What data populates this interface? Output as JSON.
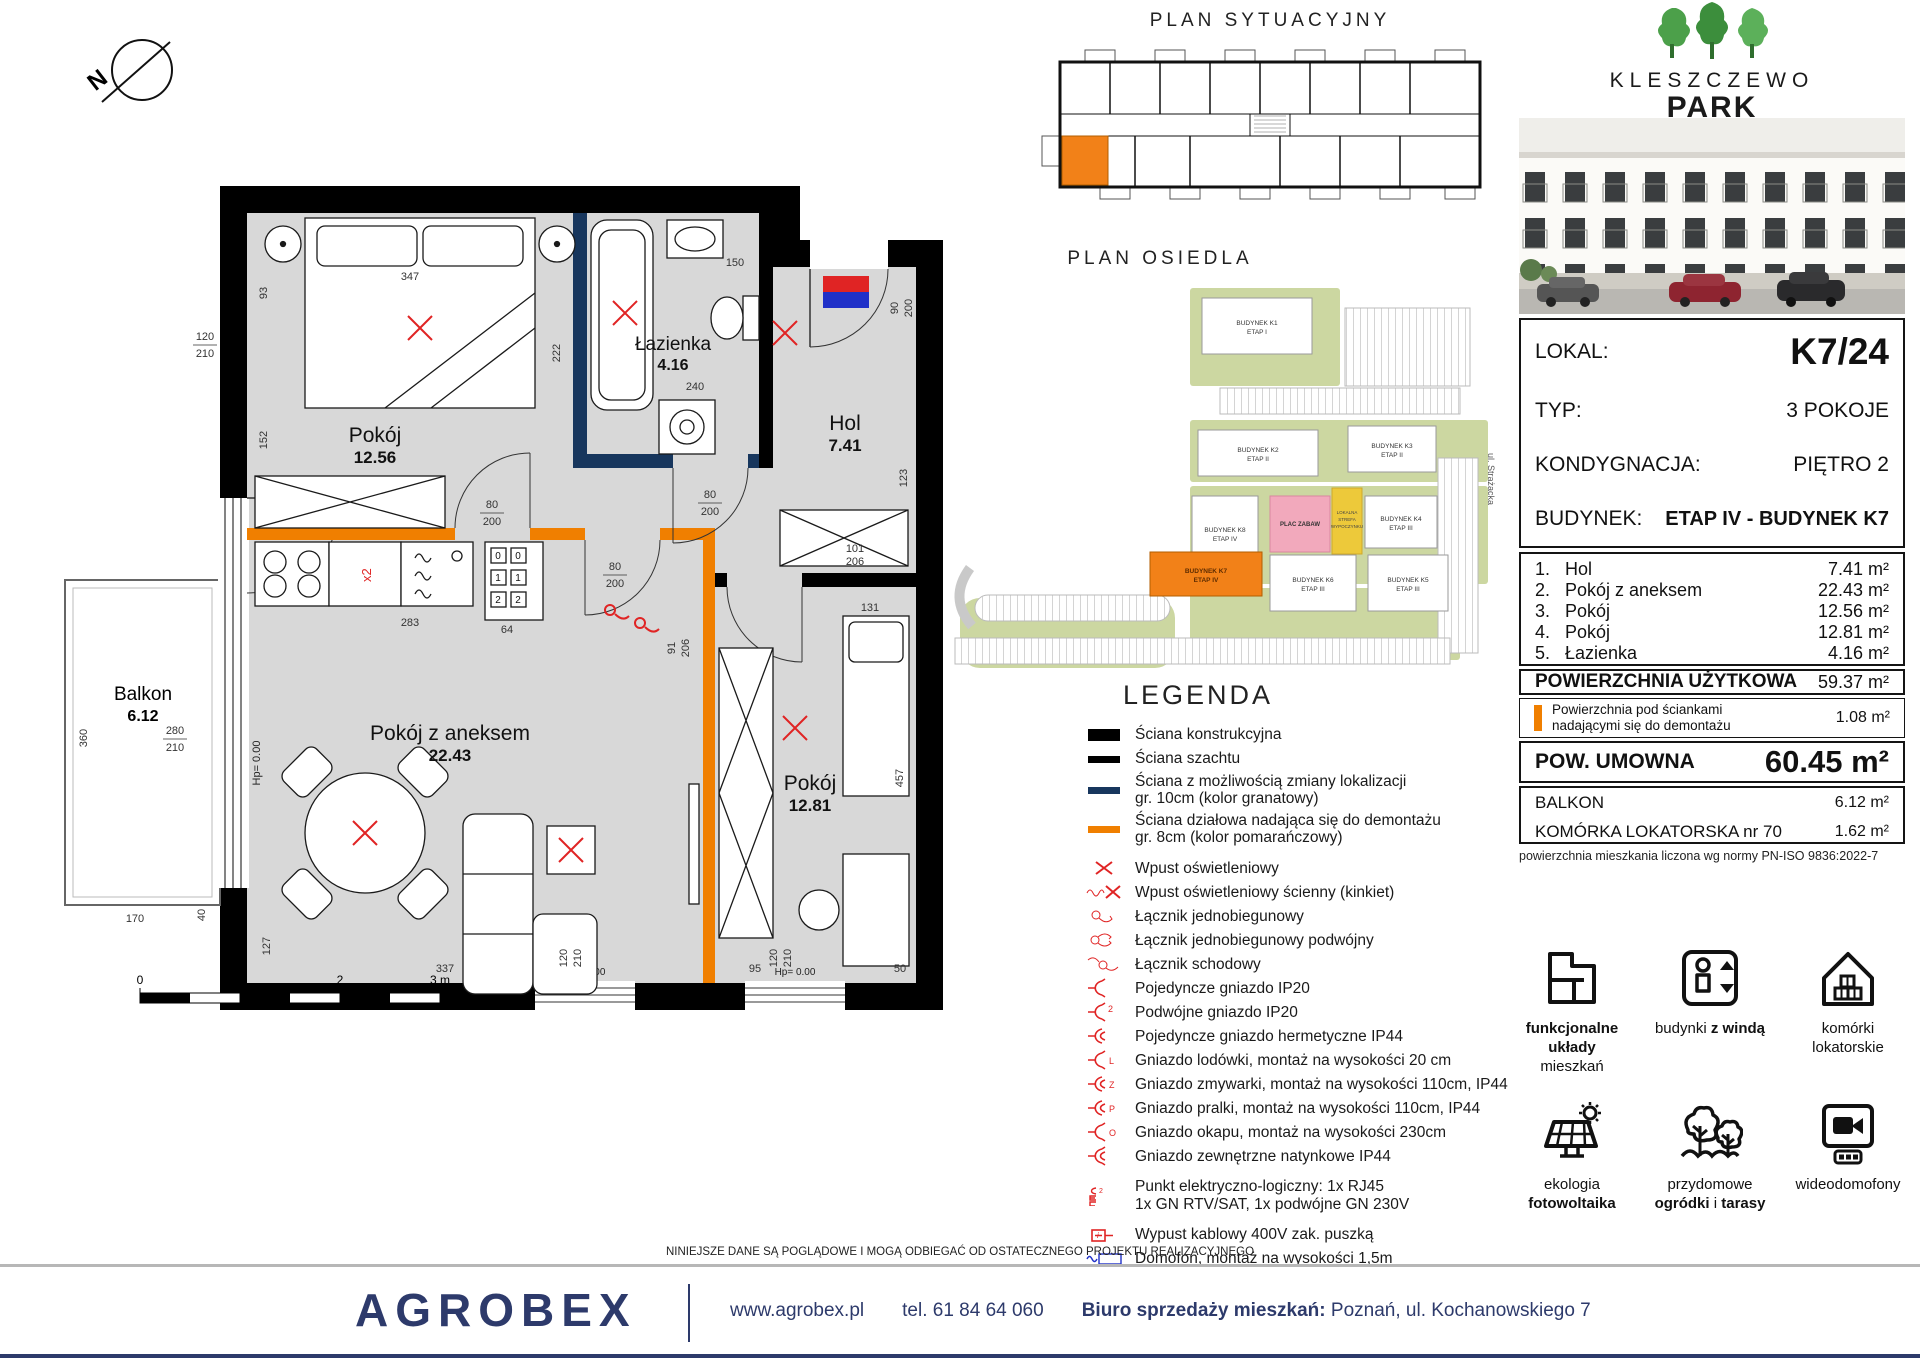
{
  "compass": {
    "label": "N"
  },
  "floor_plan": {
    "rooms": {
      "pokoj1": {
        "name": "Pokój",
        "area": "12.56"
      },
      "lazienka": {
        "name": "Łazienka",
        "area": "4.16"
      },
      "hol": {
        "name": "Hol",
        "area": "7.41"
      },
      "pokoj_aneks": {
        "name": "Pokój z aneksem",
        "area": "22.43"
      },
      "pokoj2": {
        "name": "Pokój",
        "area": "12.81"
      },
      "balkon": {
        "name": "Balkon",
        "area": "6.12"
      }
    },
    "hp_label": "Hp= 0.00",
    "socket_label": "x2",
    "appliance_codes": [
      "0",
      "0",
      "1",
      "1",
      "2",
      "2"
    ],
    "dims": {
      "d347": "347",
      "d93": "93",
      "d150": "150",
      "d120": "120",
      "d210": "210",
      "d152": "152",
      "d222": "222",
      "d240": "240",
      "d80": "80",
      "d200": "200",
      "d90": "90",
      "d101": "101",
      "d206": "206",
      "d123": "123",
      "d91": "91",
      "d283": "283",
      "d64": "64",
      "d337": "337",
      "d127": "127",
      "d457": "457",
      "d131": "131",
      "d95": "95",
      "d50": "50",
      "d360": "360",
      "d170": "170",
      "d40": "40",
      "d280": "280"
    },
    "scale_ticks": [
      "0",
      "1",
      "2",
      "3 m"
    ]
  },
  "plan_sytuacyjny": {
    "title": "PLAN SYTUACYJNY"
  },
  "plan_osiedla": {
    "title": "PLAN OSIEDLA",
    "street": "ul. Strażacka",
    "plac_zabaw": "PLAC ZABAW",
    "strefa": [
      "LOKALNA",
      "STREFA",
      "WYPOCZYNKU"
    ],
    "buildings": [
      {
        "name": "BUDYNEK K1",
        "etap": "ETAP I",
        "highlight": false
      },
      {
        "name": "BUDYNEK K2",
        "etap": "ETAP II",
        "highlight": false
      },
      {
        "name": "BUDYNEK K3",
        "etap": "ETAP II",
        "highlight": false
      },
      {
        "name": "BUDYNEK K8",
        "etap": "ETAP IV",
        "highlight": false
      },
      {
        "name": "BUDYNEK K4",
        "etap": "ETAP III",
        "highlight": false
      },
      {
        "name": "BUDYNEK K7",
        "etap": "ETAP IV",
        "highlight": true
      },
      {
        "name": "BUDYNEK K6",
        "etap": "ETAP III",
        "highlight": false
      },
      {
        "name": "BUDYNEK K5",
        "etap": "ETAP III",
        "highlight": false
      }
    ]
  },
  "legend": {
    "title": "LEGENDA",
    "items": [
      {
        "icon": "wall_constr",
        "label": "Ściana konstrukcyjna"
      },
      {
        "icon": "wall_shaft",
        "label": "Ściana szachtu"
      },
      {
        "icon": "wall_navy",
        "label": "Ściana z możliwością zmiany lokalizacji",
        "label2": "gr. 10cm (kolor granatowy)"
      },
      {
        "icon": "wall_orange",
        "label": "Ściana działowa nadająca się do demontażu",
        "label2": "gr. 8cm (kolor pomarańczowy)"
      },
      {
        "icon": "x",
        "label": "Wpust oświetleniowy"
      },
      {
        "icon": "kinkiet",
        "label": "Wpust oświetleniowy ścienny (kinkiet)"
      },
      {
        "icon": "lacznik1",
        "label": "Łącznik jednobiegunowy"
      },
      {
        "icon": "lacznik2",
        "label": "Łącznik jednobiegunowy podwójny"
      },
      {
        "icon": "lacznik_s",
        "label": "Łącznik schodowy"
      },
      {
        "icon": "gn",
        "label": "Pojedyncze gniazdo IP20"
      },
      {
        "icon": "gn2",
        "label": "Podwójne gniazdo IP20"
      },
      {
        "icon": "gnh",
        "label": "Pojedyncze gniazdo hermetyczne IP44"
      },
      {
        "icon": "gnL",
        "label": "Gniazdo lodówki, montaż na wysokości 20 cm"
      },
      {
        "icon": "gnZ",
        "label": "Gniazdo zmywarki, montaż na wysokości 110cm,  IP44"
      },
      {
        "icon": "gnP",
        "label": "Gniazdo pralki, montaż na wysokości 110cm, IP44"
      },
      {
        "icon": "gnO",
        "label": "Gniazdo okapu, montaż na wysokości 230cm"
      },
      {
        "icon": "gnN",
        "label": "Gniazdo zewnętrzne natynkowe IP44"
      },
      {
        "icon": "punkt",
        "label": "Punkt elektryczno-logiczny: 1x RJ45",
        "label2": "1x GN RTV/SAT, 1x podwójne GN 230V"
      },
      {
        "icon": "wypust",
        "label": "Wypust kablowy 400V zak. puszką"
      },
      {
        "icon": "domofon",
        "label": "Domofon, montaż na wysokości 1,5m"
      },
      {
        "icon": "tablica",
        "label": "Tablica mieszkaniowa"
      }
    ]
  },
  "brand": {
    "line1": "KLESZCZEWO",
    "line2": "PARK"
  },
  "unit": {
    "rows": [
      {
        "label": "LOKAL:",
        "value": "K7/24"
      },
      {
        "label": "TYP:",
        "value": "3 POKOJE"
      },
      {
        "label": "KONDYGNACJA:",
        "value": "PIĘTRO 2"
      },
      {
        "label": "BUDYNEK:",
        "value": "ETAP IV - BUDYNEK  K7"
      }
    ]
  },
  "areas": {
    "rows": [
      {
        "no": "1.",
        "name": "Hol",
        "value": "7.41 m²"
      },
      {
        "no": "2.",
        "name": "Pokój z aneksem",
        "value": "22.43 m²"
      },
      {
        "no": "3.",
        "name": "Pokój",
        "value": "12.56 m²"
      },
      {
        "no": "4.",
        "name": "Pokój",
        "value": "12.81 m²"
      },
      {
        "no": "5.",
        "name": "Łazienka",
        "value": "4.16 m²"
      }
    ],
    "uzytkowa_label": "POWIERZCHNIA UŻYTKOWA",
    "uzytkowa_value": "59.37 m²",
    "demontaz_line1": "Powierzchnia pod ściankami",
    "demontaz_line2": "nadającymi się do demontażu",
    "demontaz_value": "1.08 m²",
    "umowna_label": "POW. UMOWNA",
    "umowna_value": "60.45 m²",
    "balkon_label": "BALKON",
    "balkon_value": "6.12 m²",
    "komorka_label": "KOMÓRKA LOKATORSKA nr 70",
    "komorka_value": "1.62 m²",
    "norm_note": "powierzchnia mieszkania liczona wg normy PN-ISO 9836:2022-7"
  },
  "features": [
    {
      "icon": "floorplan",
      "lines": [
        [
          {
            "t": "funkcjonalne układy",
            "b": true
          }
        ],
        [
          {
            "t": "mieszkań",
            "b": false
          }
        ]
      ]
    },
    {
      "icon": "elevator",
      "lines": [
        [
          {
            "t": "budynki ",
            "b": false
          },
          {
            "t": "z windą",
            "b": true
          }
        ]
      ]
    },
    {
      "icon": "cellar",
      "lines": [
        [
          {
            "t": "komórki",
            "b": false
          }
        ],
        [
          {
            "t": "lokatorskie",
            "b": false
          }
        ]
      ]
    },
    {
      "icon": "solar",
      "lines": [
        [
          {
            "t": "ekologia",
            "b": false
          }
        ],
        [
          {
            "t": "fotowoltaika",
            "b": true
          }
        ]
      ]
    },
    {
      "icon": "garden",
      "lines": [
        [
          {
            "t": "przydomowe",
            "b": false
          }
        ],
        [
          {
            "t": "ogródki",
            "b": true
          },
          {
            "t": " i ",
            "b": false
          },
          {
            "t": "tarasy",
            "b": true
          }
        ]
      ]
    },
    {
      "icon": "videophone",
      "lines": [
        [
          {
            "t": "wideodomofony",
            "b": false
          }
        ]
      ]
    }
  ],
  "footer": {
    "disclaimer": "NINIEJSZE DANE SĄ POGLĄDOWE I MOGĄ ODBIEGAĆ OD OSTATECZNEGO PROJEKTU REALIZACYJNEGO",
    "logo": "AGROBEX",
    "website": "www.agrobex.pl",
    "phone": "tel. 61 84 64 060",
    "office_label": "Biuro sprzedaży mieszkań:",
    "office_value": "Poznań, ul. Kochanowskiego 7"
  }
}
